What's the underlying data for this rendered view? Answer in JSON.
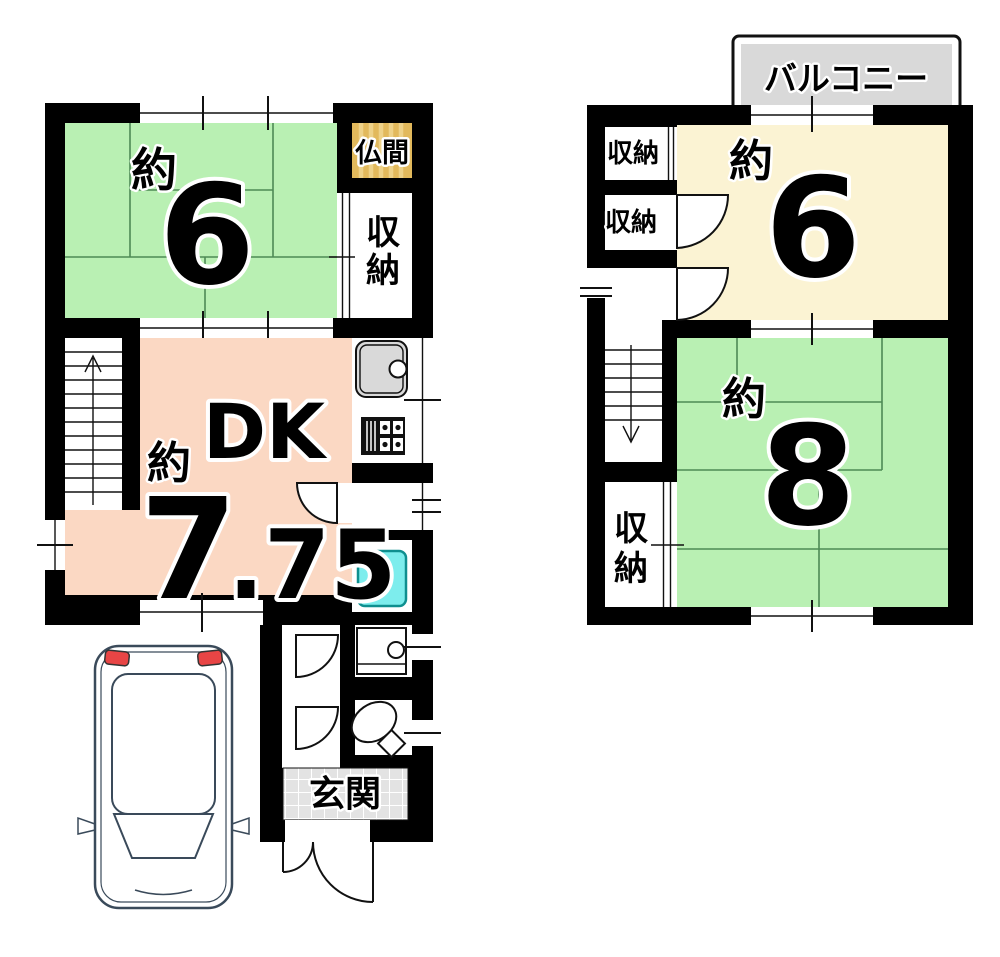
{
  "colors": {
    "wall": "#000000",
    "tatami_green": "#b9f0b3",
    "dk_salmon": "#fbd8c3",
    "room_yellow": "#fbf3d3",
    "butsuma_tan": "#e2b95c",
    "butsuma_stripe": "#eed289",
    "balcony_gray": "#d9d9d9",
    "genkan_gray": "#e3e3e3",
    "tub_cyan": "#7deded",
    "car_body_blue": "#cddef2",
    "car_roof_blue": "#d8e6f5",
    "taillight_red": "#e84545"
  },
  "floor1": {
    "tatami_room": {
      "approx": "約",
      "size": "6"
    },
    "butsuma_label": "仏間",
    "closet_chars": [
      "収",
      "納"
    ],
    "dk": {
      "name": "DK",
      "approx": "約",
      "size_int": "7",
      "size_frac": ".75"
    },
    "genkan_label": "玄関"
  },
  "floor2": {
    "balcony_label": "バルコニー",
    "closet_top_label": "収納",
    "closet_mid_label": "収納",
    "closet_bottom_chars": [
      "収",
      "納"
    ],
    "tatami_room_6": {
      "approx": "約",
      "size": "6"
    },
    "tatami_room_8": {
      "approx": "約",
      "size": "8"
    }
  }
}
